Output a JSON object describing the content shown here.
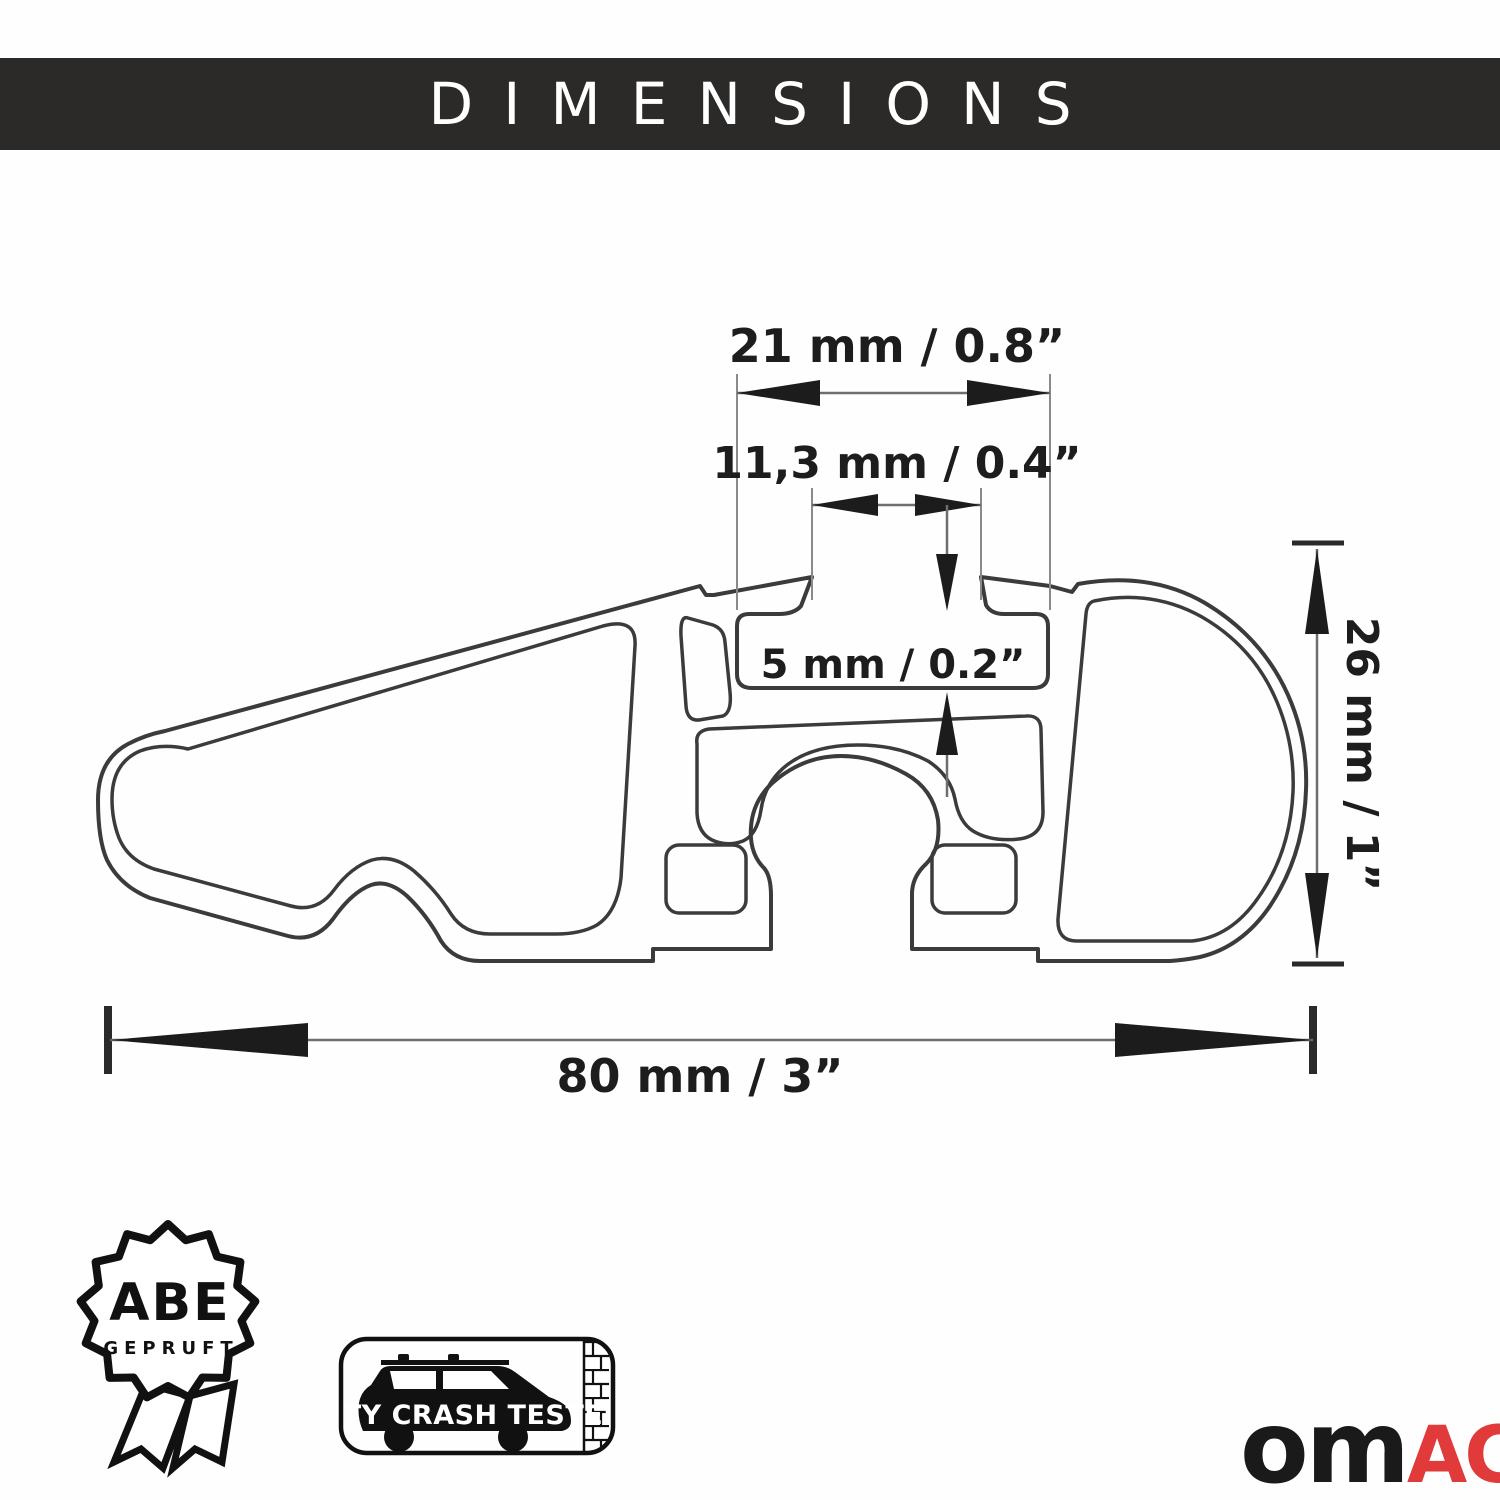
{
  "header": {
    "title": "DIMENSIONS"
  },
  "drawing": {
    "dimensions": {
      "channel_width": "21 mm / 0.8”",
      "opening_width": "11,3 mm / 0.4”",
      "channel_height": "5 mm / 0.2”",
      "profile_height": "26 mm / 1”",
      "profile_width": "80 mm / 3”"
    }
  },
  "badges": {
    "abe": {
      "title": "ABE",
      "subtitle": "GEPRUFT"
    },
    "crash_test": {
      "label": "CITY CRASH TESTED"
    }
  },
  "logo": {
    "part_black": "om",
    "part_red": "AC"
  },
  "colors": {
    "header_bg": "#2b2a29",
    "accent_red": "#e03a3a",
    "line": "#3b3b3b"
  }
}
